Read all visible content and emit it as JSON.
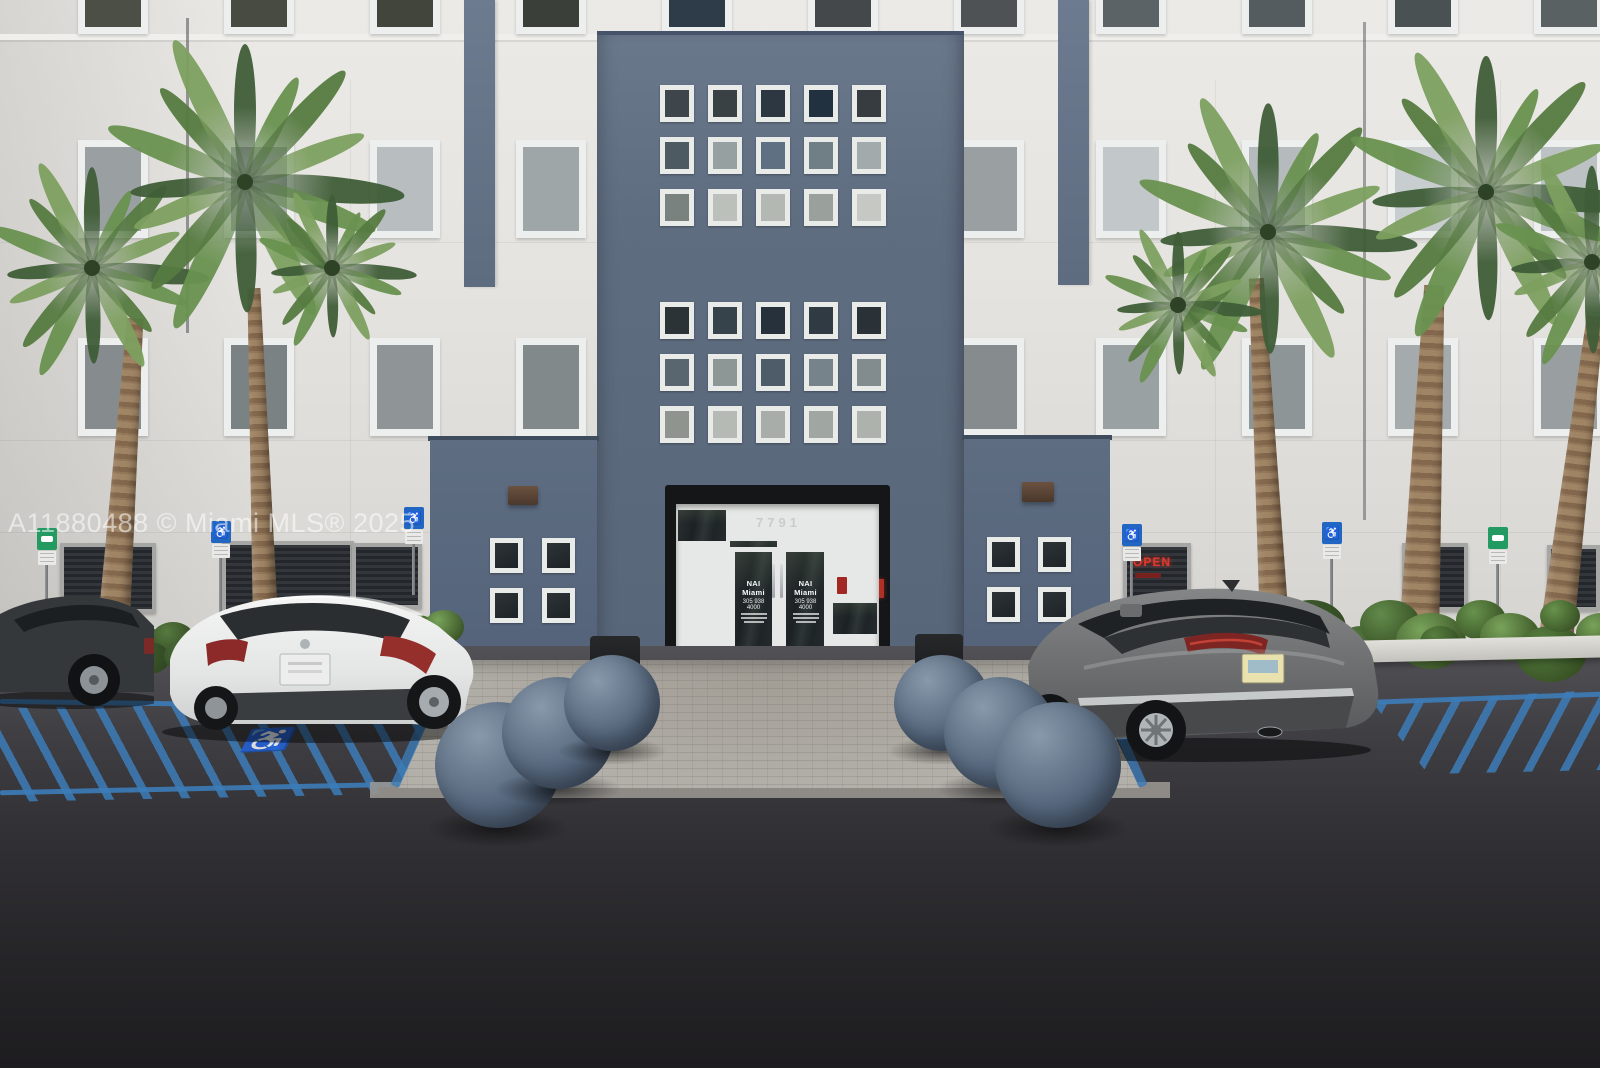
{
  "watermark": {
    "text": "A11880488 © Miami MLS® 2025"
  },
  "building": {
    "address_number": "7791",
    "entry_door_sign": {
      "brand": "NAI Miami",
      "phone": "305 938 4000"
    },
    "open_sign_text": "OPEN"
  },
  "signs": {
    "accessible_parking_sign_count": 4,
    "green_parking_sign_count": 2
  },
  "icons": {
    "wheelchair": "♿"
  },
  "colors": {
    "accent_blue_wall": "#5e6c80",
    "facade_white": "#e6e4e0",
    "handicap_paint_blue": "#3c7cb8",
    "open_sign_red": "#e2382c",
    "palm_green": "#68904f",
    "asphalt": "#2e2d30",
    "sphere_bollard": "#5a6a7d"
  }
}
